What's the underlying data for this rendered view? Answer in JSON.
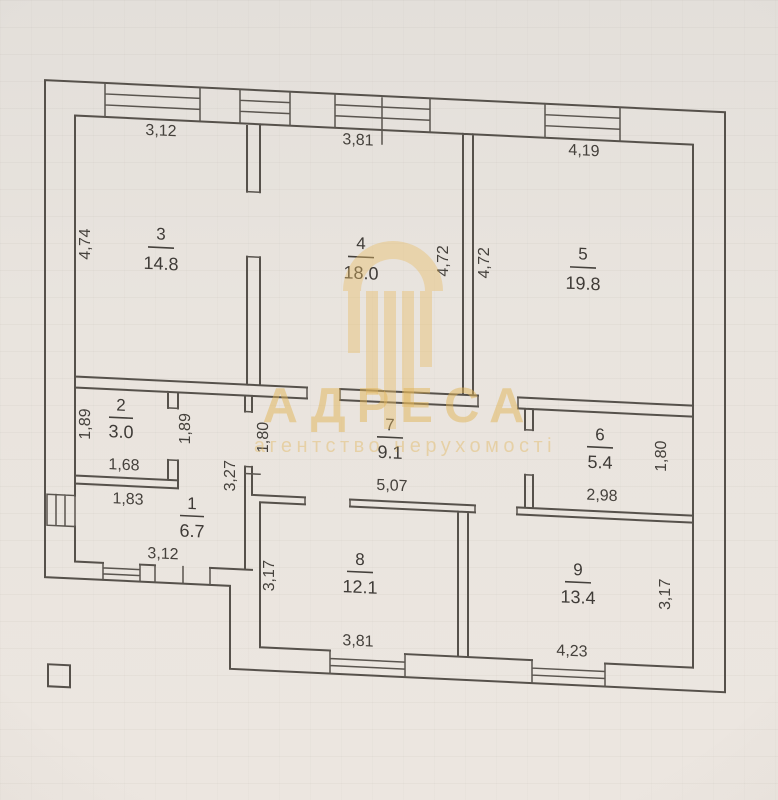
{
  "document": {
    "type": "apartment floor plan",
    "paper_color": "#e9e4de",
    "line_color": "#56514b"
  },
  "watermark": {
    "title": "АДРЕСА",
    "subtitle": "агентство нерухомості",
    "logo": "building-columns-icon",
    "color": "#e2b558"
  },
  "rooms": [
    {
      "number": "1",
      "area": "6.7",
      "dims": {
        "bottom": "3,12",
        "right": "3,27",
        "inner_width": "1,83"
      }
    },
    {
      "number": "2",
      "area": "3.0",
      "dims": {
        "left": "1,89",
        "right": "1,89",
        "bottom": "1,68"
      }
    },
    {
      "number": "3",
      "area": "14.8",
      "dims": {
        "top": "3,12",
        "left": "4,74"
      }
    },
    {
      "number": "4",
      "area": "18.0",
      "dims": {
        "top": "3,81",
        "right": "4,72"
      }
    },
    {
      "number": "5",
      "area": "19.8",
      "dims": {
        "top": "4,19",
        "left": "4,72"
      }
    },
    {
      "number": "6",
      "area": "5.4",
      "dims": {
        "bottom": "2,98",
        "right": "1,80"
      }
    },
    {
      "number": "7",
      "area": "9.1",
      "dims": {
        "left": "1,80",
        "bottom": "5,07"
      }
    },
    {
      "number": "8",
      "area": "12.1",
      "dims": {
        "left": "3,17",
        "bottom": "3,81"
      }
    },
    {
      "number": "9",
      "area": "13.4",
      "dims": {
        "right": "3,17",
        "bottom": "4,23"
      }
    }
  ]
}
